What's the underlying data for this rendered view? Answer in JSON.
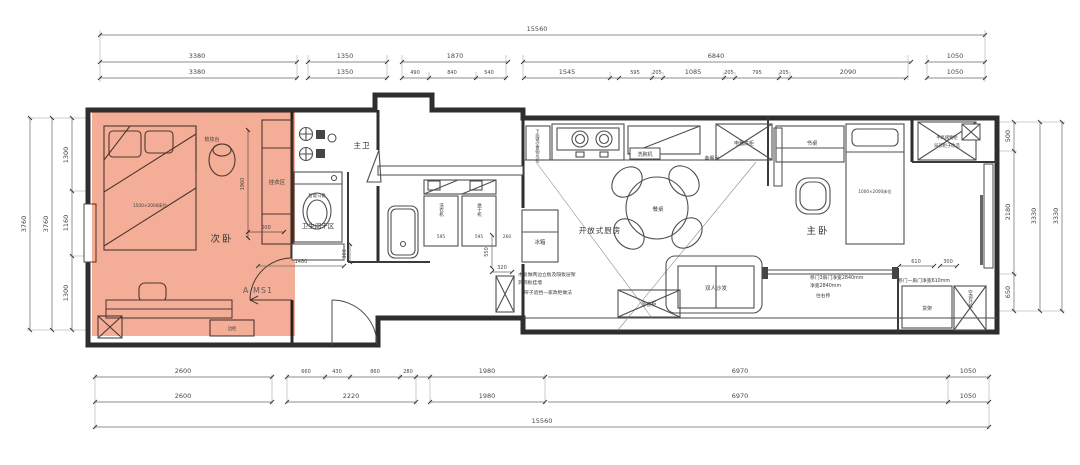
{
  "colors": {
    "highlight": "#f3a287",
    "wall": "#2e2e2e",
    "dim_text": "#474747"
  },
  "dims": {
    "top_overall": "15560",
    "top_row2": [
      "3380",
      "1350",
      "1870",
      "6840",
      "1050"
    ],
    "top_row3": [
      "3380",
      "1350",
      "490",
      "840",
      "540",
      "1545",
      "595",
      "205",
      "1085",
      "205",
      "795",
      "205",
      "2090",
      "1050"
    ],
    "bottom_row1": [
      "2600",
      "660",
      "430",
      "860",
      "280",
      "1980",
      "6970",
      "1050"
    ],
    "bottom_row2": [
      "2600",
      "2220",
      "1980",
      "6970",
      "1050"
    ],
    "bottom_overall": "15560",
    "left_outer": [
      "3760",
      "3760"
    ],
    "left_inner": [
      "1300",
      "1160",
      "1300"
    ],
    "right_inner": [
      "500",
      "2180",
      "650"
    ],
    "right_outer": [
      "3330",
      "3330"
    ],
    "bedroom2_height": "1960",
    "bedroom2_width": "600",
    "bath_width": "1480",
    "bath_depth": "300",
    "washer_width": "595",
    "dryer_width": "595",
    "gap_width": "260",
    "cabinet_height": "550",
    "cabinet_width": "320",
    "slider_width": "610",
    "slider_side": "300"
  },
  "rooms": {
    "bedroom2": "次卧",
    "master": "主卧",
    "master_bath": "主卫",
    "dry_area": "卫生间干区",
    "kitchen": "开放式厨房"
  },
  "labels": {
    "marker": "A-MS1",
    "dressing_table": "梳妆台",
    "hanging_area": "挂衣区",
    "bed2_size": "1500×2000床位",
    "smart_toilet": "智能马桶",
    "side_cabinet": "边柜",
    "washer": "洗衣机",
    "dryer": "烘干机",
    "fridge": "冰箱",
    "upper_cabinet": "下面镂空置物吊柜",
    "dishwasher": "洗碗机",
    "prep_counter": "备餐台",
    "tall_cabinet": "电器高柜",
    "dining_table": "餐桌",
    "desk": "书桌",
    "bed1_size": "1000×2000床位",
    "half_cabinet_1": "半高储物柜",
    "half_cabinet_2": "局部柜子改造",
    "sofa": "双人沙发",
    "snack_cabinet": "零食柜",
    "shelf": "货架",
    "ac_unit": "空调外机",
    "utility_note": [
      "木板做两边立板及隔板层架",
      "洞洞板挂墙",
      "帘子遮挡—家政柜做法"
    ],
    "slider_note": [
      "移门3扇门净宽2840mm",
      "净宽2840mm",
      "往右移"
    ],
    "slider_note2": "移门一扇门净宽610mm"
  }
}
